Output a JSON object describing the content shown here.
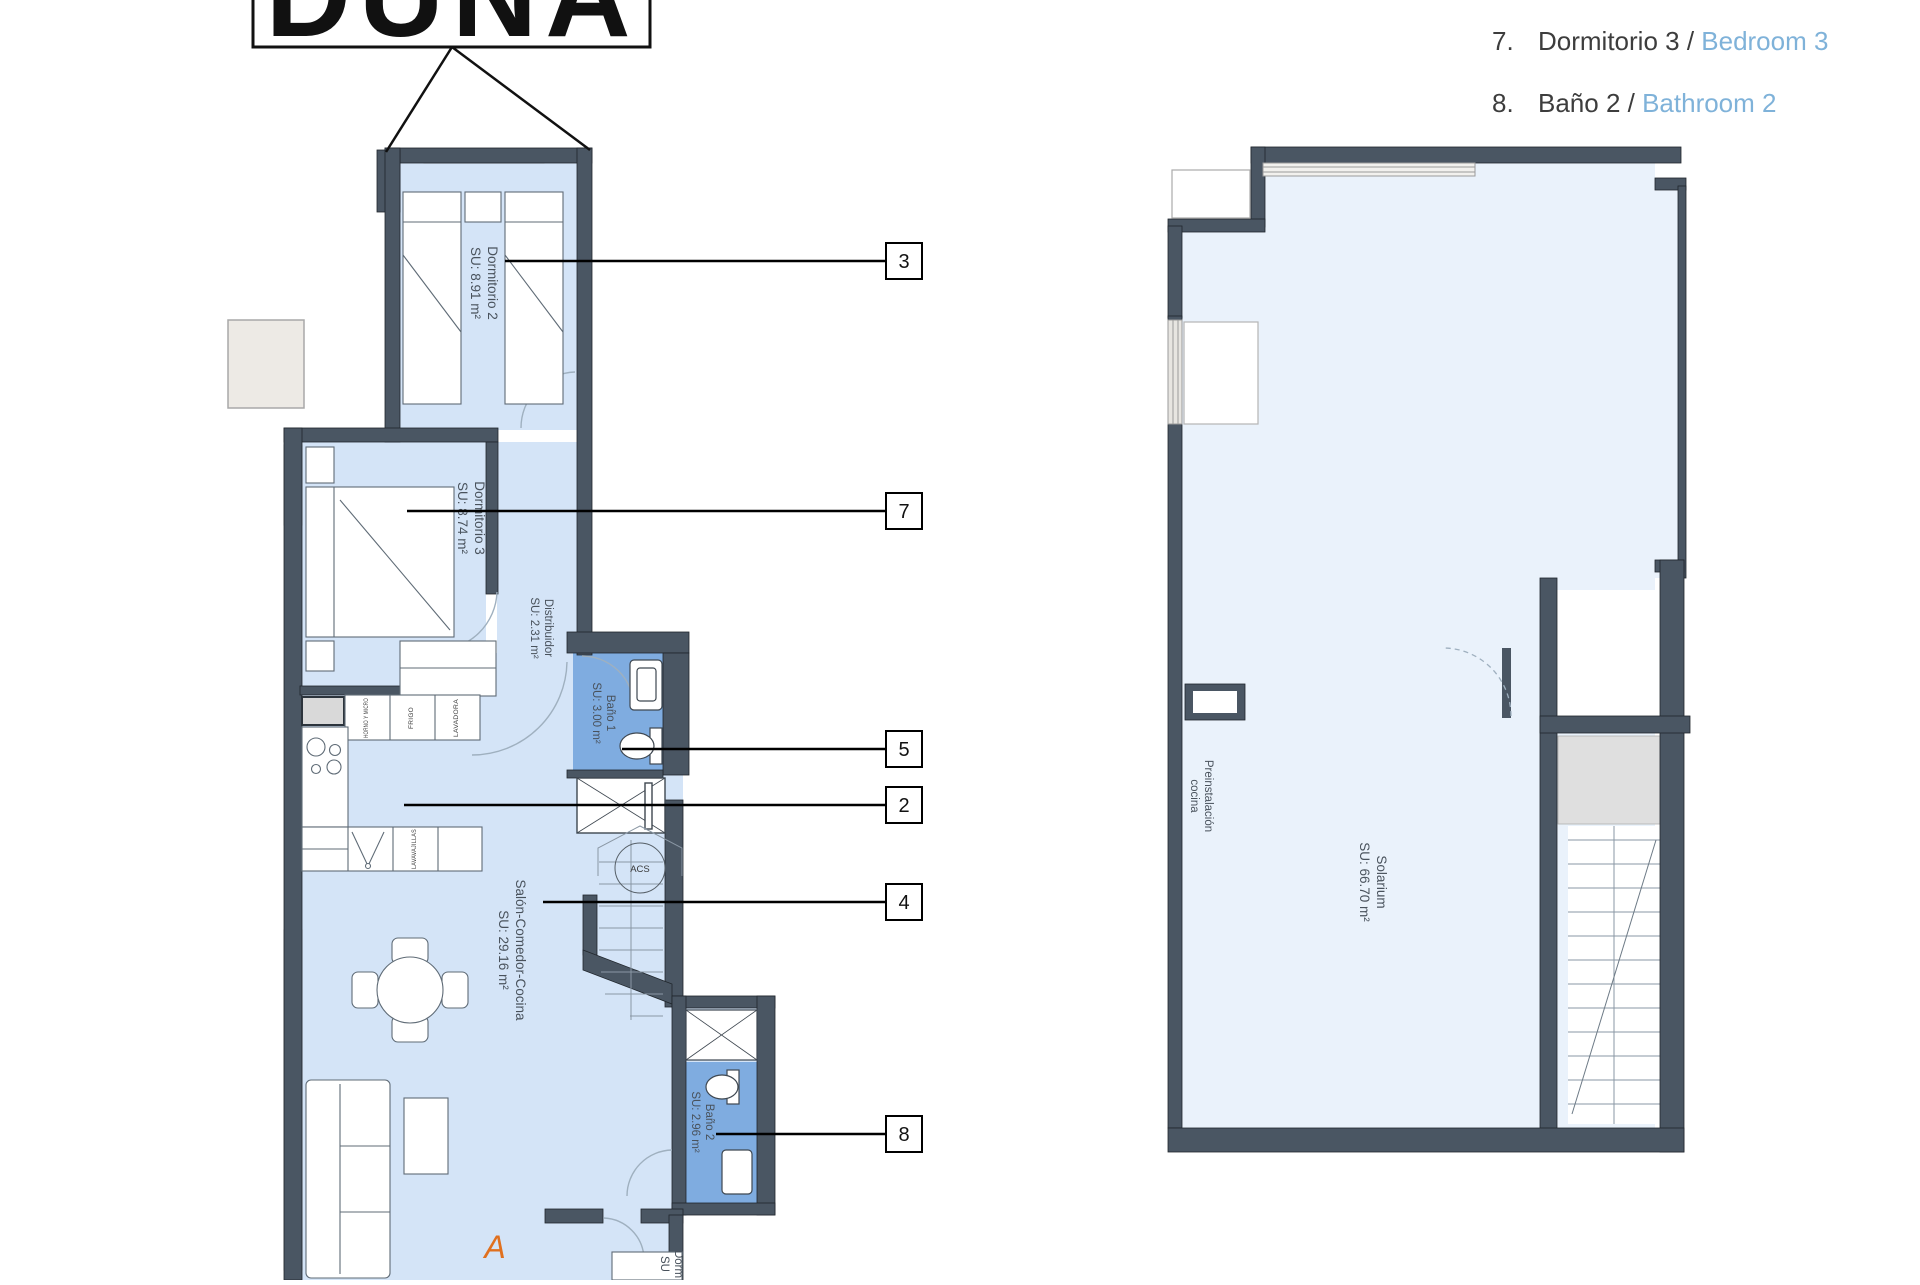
{
  "title_block": {
    "label": "DUNA"
  },
  "legend": {
    "items": [
      {
        "number": "7.",
        "name_es": "Dormitorio 3",
        "separator": " / ",
        "name_en": "Bedroom 3"
      },
      {
        "number": "8.",
        "name_es": "Baño 2",
        "separator": " / ",
        "name_en": "Bathroom 2"
      }
    ]
  },
  "left_plan": {
    "rooms": [
      {
        "name": "Dormitorio 2",
        "area": "SU: 8.91 m²"
      },
      {
        "name": "Dormitorio 3",
        "area": "SU: 8.74 m²"
      },
      {
        "name": "Distribuidor",
        "area": "SU: 2.31 m²"
      },
      {
        "name": "Baño 1",
        "area": "SU: 3.00 m²"
      },
      {
        "name": "Salón-Comedor-Cocina",
        "area": "SU: 29.16 m²"
      },
      {
        "name": "Baño 2",
        "area": "SU: 2.96 m²"
      },
      {
        "name": "Dorm",
        "area": "SU"
      }
    ],
    "appliances": [
      "HORNO Y MICRO",
      "FRIGO",
      "LAVADORA",
      "LAVAVAJILLAS"
    ],
    "water_heater_label": "ACS",
    "section_marker": "A",
    "callouts": [
      "3",
      "7",
      "5",
      "2",
      "4",
      "8"
    ]
  },
  "right_plan": {
    "rooms": [
      {
        "name": "Solarium",
        "area": "SU: 66.70 m²"
      }
    ],
    "prewiring_label_line1": "Preinstalación",
    "prewiring_label_line2": "cocina"
  },
  "colors": {
    "wall": "#4a5663",
    "floor": "#d4e4f7",
    "bathroom_floor": "#7face0",
    "solarium_floor": "#eaf2fb",
    "legend_blue": "#7fb2d9",
    "marker_orange": "#e0701f"
  }
}
